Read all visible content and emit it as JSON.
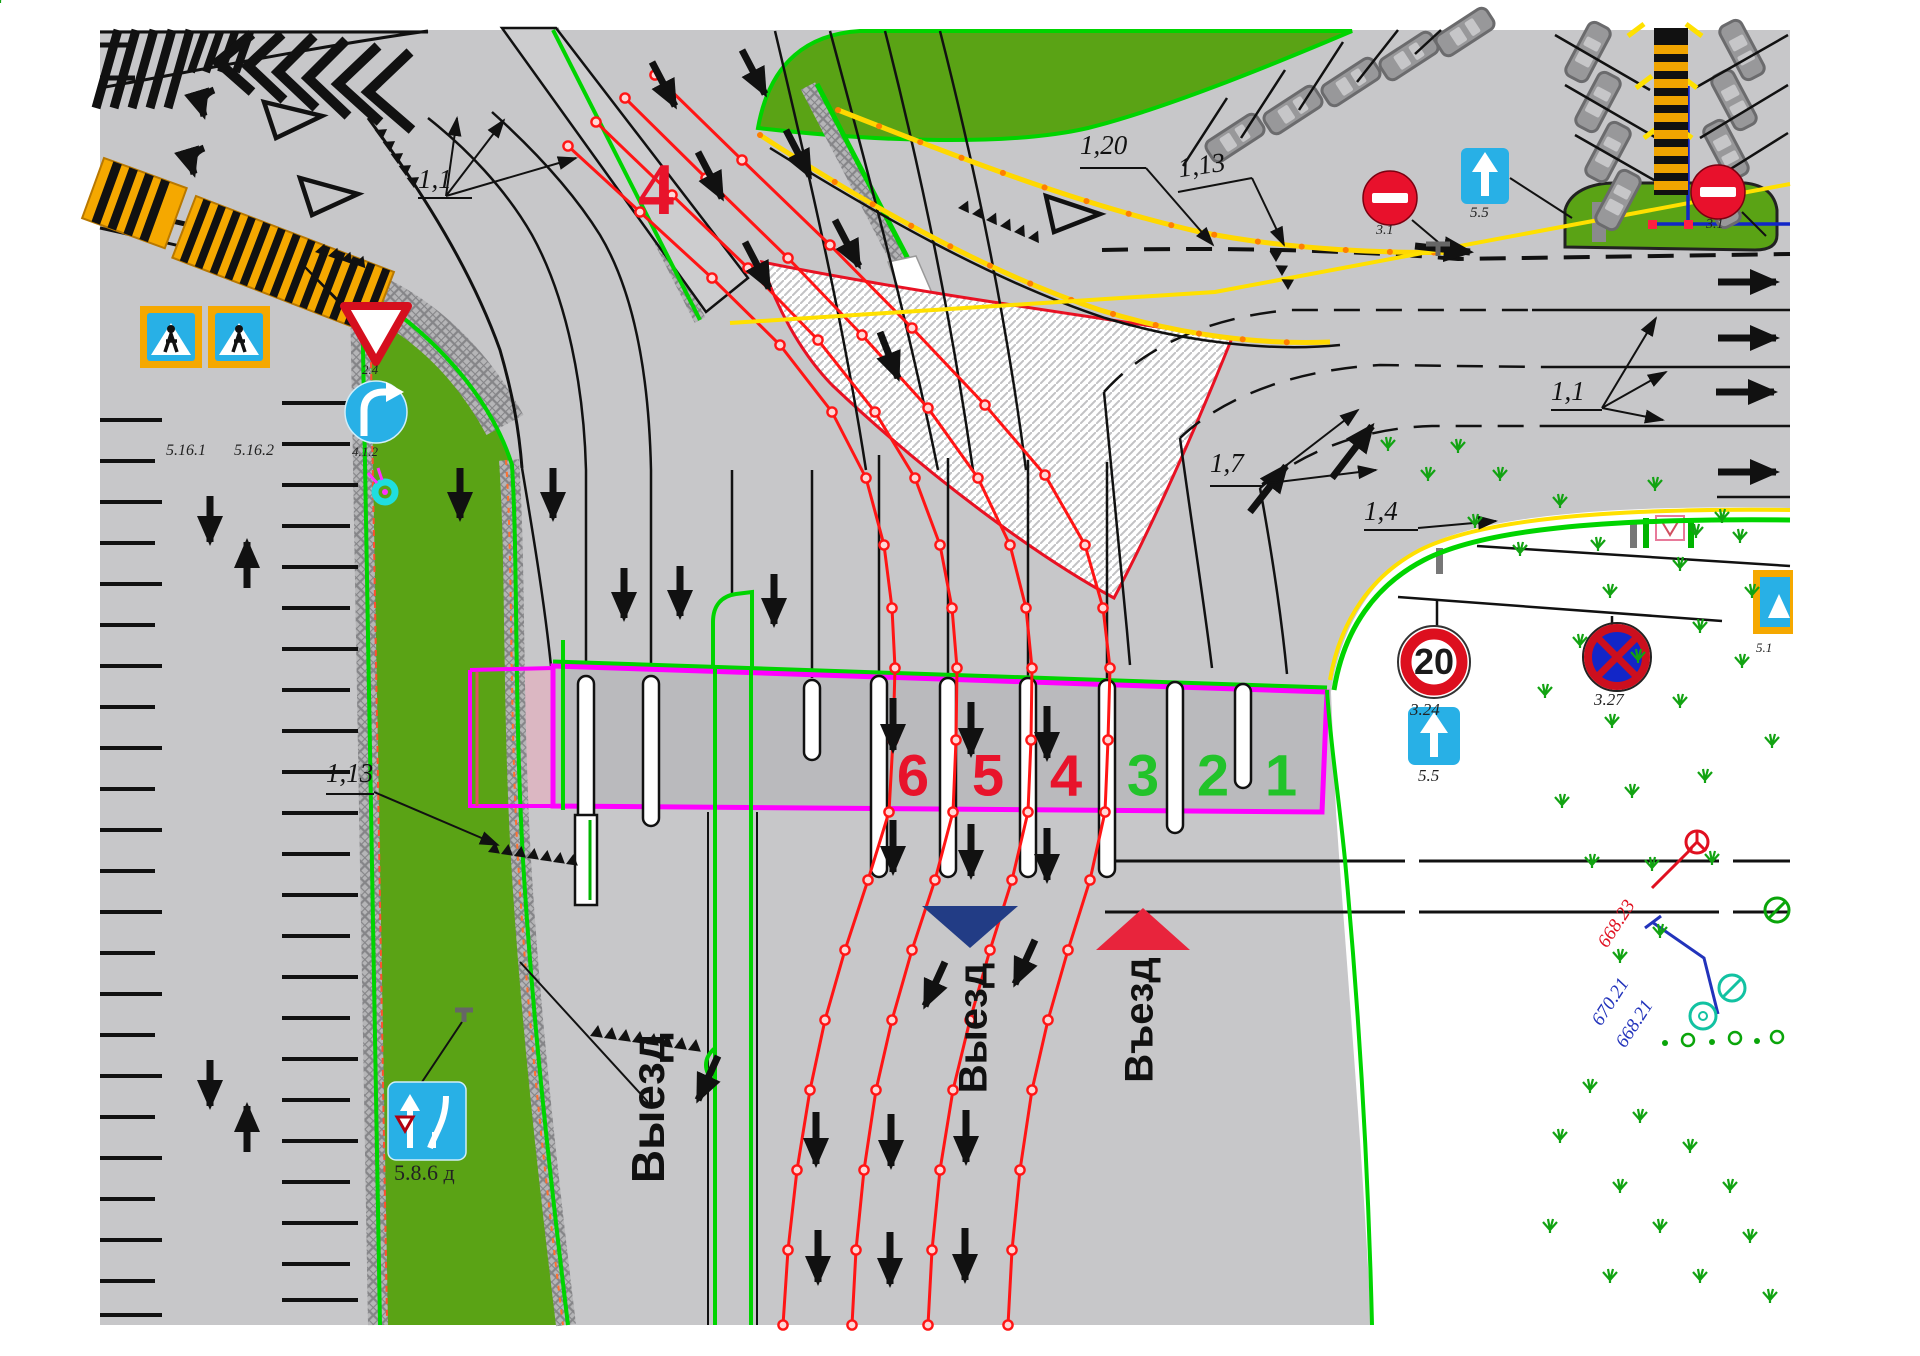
{
  "app": {
    "type": "traffic management plan drawing"
  },
  "labels": {
    "marking_1_1_topleft": "1,1",
    "marking_1_1_right": "1,1",
    "marking_1_20": "1,20",
    "marking_1_13_top": "1,13",
    "marking_1_13_left": "1,13",
    "marking_1_7": "1,7",
    "marking_1_4": "1,4",
    "road_number": "4"
  },
  "lanes": {
    "exit": [
      "6",
      "5",
      "4"
    ],
    "entry": [
      "3",
      "2",
      "1"
    ]
  },
  "directions": {
    "exit_left": "Выезд",
    "exit_mid": "Выезд",
    "entry": "Въезд"
  },
  "signs": {
    "ped_crossing_1": "5.16.1",
    "ped_crossing_2": "5.16.2",
    "give_way": "2.4",
    "direction_right": "4.1.2",
    "no_entry_1": "3.1",
    "no_entry_2": "3.1",
    "one_way_top": "5.5",
    "one_way_side": "5.5",
    "speed_limit_code": "3.24",
    "speed_limit_value": "20",
    "no_stopping": "3.27",
    "lane_merge": "5.8.6 д",
    "edge_sign": "5.1"
  },
  "elevations": {
    "mark_red": "668.23",
    "mark_blue_top": "670.21",
    "mark_blue_bottom": "668.21"
  },
  "colors": {
    "road": "#c7c7c9",
    "grass": "#5aa315",
    "edge_green": "#00d400",
    "route_red": "#ff1515",
    "boundary_magenta": "#ff00ff",
    "crosswalk_orange": "#f5a800",
    "sign_blue": "#28b0e6",
    "sign_red": "#dd0f1e",
    "elevation_red": "#e01020",
    "elevation_blue": "#2233bb",
    "lane_exit": "#e8132b",
    "lane_entry": "#22c32a"
  }
}
